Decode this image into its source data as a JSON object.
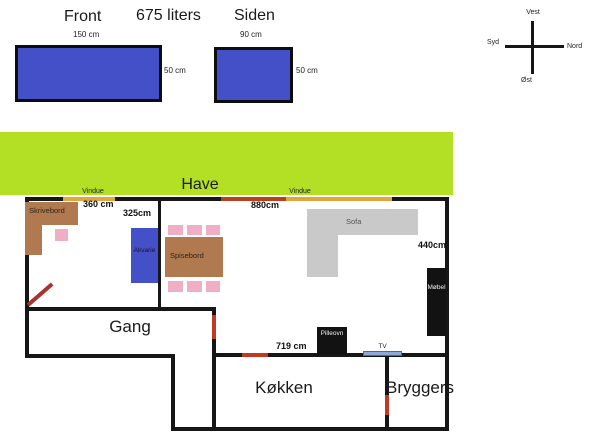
{
  "title_row": {
    "front": "Front",
    "volume": "675 liters",
    "side": "Siden"
  },
  "tanks": {
    "front": {
      "width": "150 cm",
      "height": "50 cm"
    },
    "side": {
      "width": "90 cm",
      "height": "50 cm"
    }
  },
  "compass": {
    "top": "Vest",
    "left": "Syd",
    "right": "Nord",
    "bottom": "Øst"
  },
  "garden_label": "Have",
  "plan": {
    "window_label_1": "Vindue",
    "window_label_2": "Vindue",
    "rooms": {
      "hall": "Gang",
      "kitchen": "Køkken",
      "utility": "Bryggers"
    },
    "furniture": {
      "desk": "Skrivebord",
      "aquarium": "Akvarie",
      "dining_table": "Spisebord",
      "sofa": "Sofa",
      "cabinet": "Møbel",
      "stove": "Pilleovn",
      "tv": "TV"
    },
    "measurements": {
      "m360": "360 cm",
      "m325": "325cm",
      "m880": "880cm",
      "m440": "440cm",
      "m719": "719 cm"
    }
  },
  "colors": {
    "tank_blue": "#4450c8",
    "garden_green": "#b3df25",
    "wall_black": "#161616",
    "window_gold": "#dfa63c",
    "door_red": "#c03a22",
    "diag_red": "#a93230",
    "desk_brown": "#b1794f",
    "chair_pink": "#efaec6",
    "sofa_gray": "#c9c9c9",
    "furniture_black": "#121212",
    "tv_blue": "#8fa9d6"
  }
}
